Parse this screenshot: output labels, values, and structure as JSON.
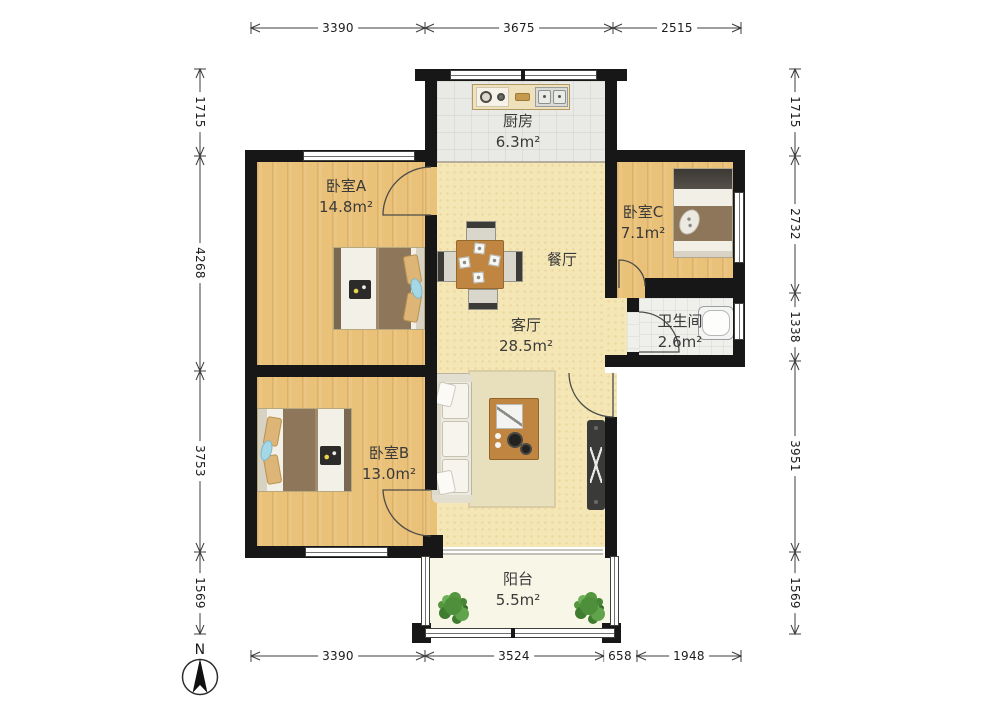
{
  "compass": {
    "label": "N"
  },
  "rooms": {
    "kitchen": {
      "name": "厨房",
      "area": "6.3m²"
    },
    "bedroom_a": {
      "name": "卧室A",
      "area": "14.8m²"
    },
    "bedroom_c": {
      "name": "卧室C",
      "area": "7.1m²"
    },
    "dining": {
      "name": "餐厅"
    },
    "living": {
      "name": "客厅",
      "area": "28.5m²"
    },
    "bathroom": {
      "name": "卫生间",
      "area": "2.6m²"
    },
    "bedroom_b": {
      "name": "卧室B",
      "area": "13.0m²"
    },
    "balcony": {
      "name": "阳台",
      "area": "5.5m²"
    }
  },
  "dimensions": {
    "top": [
      "3390",
      "3675",
      "2515"
    ],
    "bottom": [
      "3390",
      "3524",
      "658",
      "1948"
    ],
    "left": [
      "1715",
      "4268",
      "3753",
      "1569"
    ],
    "right": [
      "1715",
      "2732",
      "1338",
      "3951",
      "1569"
    ]
  },
  "palette": {
    "wall": "#171717",
    "wood_floor": "#eac178",
    "living_floor": "#f5e6b6",
    "kitchen_floor": "#e9e9e6",
    "bathroom_floor": "#efefec",
    "balcony_floor": "#f8f6e7",
    "rug": "#e8dfbc",
    "blanket": "#8d7659",
    "furniture_wood": "#c08641",
    "plant": "#4e8f3b",
    "dimension_text": "#1c1c1c"
  }
}
